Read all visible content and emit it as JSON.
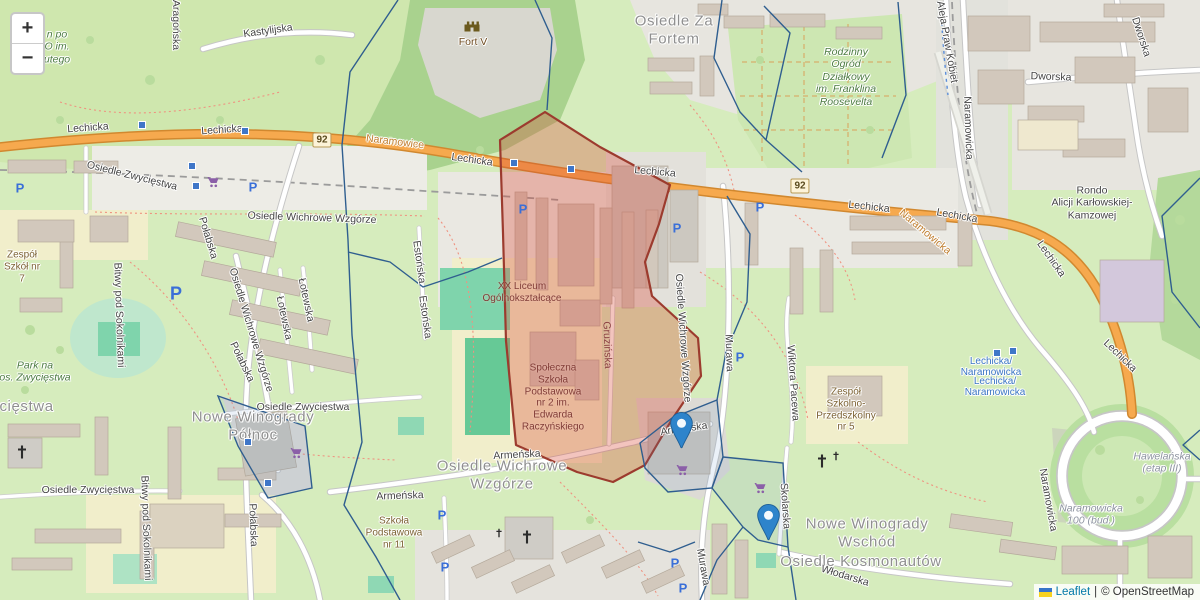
{
  "map": {
    "controls": {
      "zoom_in": "+",
      "zoom_out": "−"
    },
    "attribution": {
      "leaflet": "Leaflet",
      "separator": "|",
      "osm": "© OpenStreetMap"
    },
    "road_refs": [
      {
        "text": "92",
        "x": 322,
        "y": 140
      },
      {
        "text": "92",
        "x": 800,
        "y": 186
      }
    ],
    "labels": [
      {
        "t": "Osiedle Za\nFortem",
        "x": 674,
        "y": 30,
        "c": "district"
      },
      {
        "t": "Nowe Winogrady\nPółnoc",
        "x": 253,
        "y": 426,
        "c": "district"
      },
      {
        "t": "Osiedle Wichrowe\nWzgórze",
        "x": 502,
        "y": 475,
        "c": "district"
      },
      {
        "t": "Nowe Winogrady\nWschód",
        "x": 867,
        "y": 533,
        "c": "district"
      },
      {
        "t": "Osiedle Kosmonautów",
        "x": 861,
        "y": 562,
        "c": "district"
      },
      {
        "t": "Osiedle Zwycięstwa",
        "x": -18,
        "y": 407,
        "c": "district"
      },
      {
        "t": "Lechicka",
        "x": 88,
        "y": 128,
        "c": "street",
        "r": -4
      },
      {
        "t": "Lechicka",
        "x": 222,
        "y": 130,
        "c": "street",
        "r": -4
      },
      {
        "t": "Lechicka",
        "x": 472,
        "y": 160,
        "c": "street",
        "r": 8
      },
      {
        "t": "Lechicka",
        "x": 655,
        "y": 172,
        "c": "street",
        "r": 5
      },
      {
        "t": "Lechicka",
        "x": 869,
        "y": 207,
        "c": "street",
        "r": 6
      },
      {
        "t": "Lechicka",
        "x": 957,
        "y": 216,
        "c": "street",
        "r": 10
      },
      {
        "t": "Lechicka",
        "x": 1051,
        "y": 259,
        "c": "street",
        "r": 55
      },
      {
        "t": "Lechicka",
        "x": 1120,
        "y": 356,
        "c": "street",
        "r": 44
      },
      {
        "t": "Kastylijska",
        "x": 268,
        "y": 31,
        "c": "street",
        "r": -8
      },
      {
        "t": "Aragońska",
        "x": 176,
        "y": 25,
        "c": "street",
        "r": 90
      },
      {
        "t": "Dworska",
        "x": 1051,
        "y": 77,
        "c": "street",
        "r": 2
      },
      {
        "t": "Dworska",
        "x": 1141,
        "y": 37,
        "c": "street",
        "r": 72
      },
      {
        "t": "Osiedle Wichrowe Wzgórze",
        "x": 312,
        "y": 218,
        "c": "street",
        "r": 2
      },
      {
        "t": "Osiedle Wichrowe Wzgórze",
        "x": 251,
        "y": 330,
        "c": "street",
        "r": 73
      },
      {
        "t": "Osiedle Wichrowe Wzgórze",
        "x": 683,
        "y": 338,
        "c": "street",
        "r": 86
      },
      {
        "t": "Osiedle Zwycięstwa",
        "x": 132,
        "y": 176,
        "c": "street",
        "r": 14
      },
      {
        "t": "Osiedle Zwycięstwa",
        "x": 303,
        "y": 407,
        "c": "street"
      },
      {
        "t": "Osiedle Zwycięstwa",
        "x": 88,
        "y": 490,
        "c": "street"
      },
      {
        "t": "Połabska",
        "x": 208,
        "y": 238,
        "c": "street",
        "r": 73
      },
      {
        "t": "Połabska",
        "x": 242,
        "y": 362,
        "c": "street",
        "r": 64
      },
      {
        "t": "Połabska",
        "x": 253,
        "y": 525,
        "c": "street",
        "r": 88
      },
      {
        "t": "Bitwy pod Sokolnikami",
        "x": 119,
        "y": 315,
        "c": "street",
        "r": 88
      },
      {
        "t": "Bitwy pod Sokolnikami",
        "x": 146,
        "y": 528,
        "c": "street",
        "r": 88
      },
      {
        "t": "Estońska",
        "x": 419,
        "y": 262,
        "c": "street",
        "r": 82
      },
      {
        "t": "Estońska",
        "x": 425,
        "y": 317,
        "c": "street",
        "r": 82
      },
      {
        "t": "Łotewska",
        "x": 284,
        "y": 318,
        "c": "street",
        "r": 78
      },
      {
        "t": "Łotewska",
        "x": 306,
        "y": 300,
        "c": "street",
        "r": 78
      },
      {
        "t": "Gruzińska",
        "x": 607,
        "y": 345,
        "c": "street-red",
        "r": 88
      },
      {
        "t": "Murawa",
        "x": 729,
        "y": 353,
        "c": "street",
        "r": 88
      },
      {
        "t": "Murawa",
        "x": 703,
        "y": 567,
        "c": "street",
        "r": 80
      },
      {
        "t": "Armeńska",
        "x": 517,
        "y": 455,
        "c": "street",
        "r": -3
      },
      {
        "t": "Armeńska",
        "x": 400,
        "y": 496,
        "c": "street",
        "r": -2
      },
      {
        "t": "Armeńska",
        "x": 684,
        "y": 429,
        "c": "street",
        "r": -8
      },
      {
        "t": "Wiktora Pacewa",
        "x": 793,
        "y": 383,
        "c": "street",
        "r": 86
      },
      {
        "t": "Skolarska",
        "x": 785,
        "y": 506,
        "c": "street",
        "r": 86
      },
      {
        "t": "Włodarska",
        "x": 845,
        "y": 576,
        "c": "street",
        "r": 17
      },
      {
        "t": "Naramowicka",
        "x": 968,
        "y": 128,
        "c": "street",
        "r": 88
      },
      {
        "t": "Naramowicka",
        "x": 1048,
        "y": 500,
        "c": "street",
        "r": 80
      },
      {
        "t": "Aleja Praw Kobiet",
        "x": 947,
        "y": 42,
        "c": "street",
        "r": 80
      },
      {
        "t": "Rondo\nAlicji Karłowskiej-\nKamzowej",
        "x": 1092,
        "y": 203,
        "c": "street"
      },
      {
        "t": "Lechicka/\nNaramowicka",
        "x": 991,
        "y": 367,
        "c": "transit"
      },
      {
        "t": "Lechicka/\nNaramowicka",
        "x": 995,
        "y": 387,
        "c": "transit"
      },
      {
        "t": "Naramowice",
        "x": 395,
        "y": 142,
        "c": "orange",
        "r": 7
      },
      {
        "t": "Naramowicka",
        "x": 925,
        "y": 232,
        "c": "orange",
        "r": 40
      },
      {
        "t": "Fort V",
        "x": 473,
        "y": 42,
        "c": "fort"
      },
      {
        "t": "Zespół\nSzkół nr\n7",
        "x": 22,
        "y": 267,
        "c": "school"
      },
      {
        "t": "XX Liceum\nOgólnokształcące",
        "x": 522,
        "y": 293,
        "c": "school-red"
      },
      {
        "t": "Społeczna\nSzkoła\nPodstawowa\nnr 2 im.\nEdwarda\nRaczyńskiego",
        "x": 553,
        "y": 398,
        "c": "school-red"
      },
      {
        "t": "Szkoła\nPodstawowa\nnr 11",
        "x": 394,
        "y": 533,
        "c": "school"
      },
      {
        "t": "Zespół\nSzkolno-\nPrzedszkolny\nnr 5",
        "x": 846,
        "y": 410,
        "c": "school"
      },
      {
        "t": "Rodzinny\nOgród\nDziałkowy\nim. Franklina\nRoosevelta",
        "x": 846,
        "y": 77,
        "c": "park"
      },
      {
        "t": "Park na\nos. Zwycięstwa",
        "x": 35,
        "y": 372,
        "c": "park"
      },
      {
        "t": "n po\nO im.\nutego",
        "x": 57,
        "y": 47,
        "c": "park"
      },
      {
        "t": "Hawelańska\n(etap III)",
        "x": 1162,
        "y": 463,
        "c": "gray-i"
      },
      {
        "t": "Naramowicka\n100 (bud.)",
        "x": 1091,
        "y": 515,
        "c": "gray-i"
      }
    ],
    "markers": [
      {
        "x": 681,
        "y": 449
      },
      {
        "x": 768,
        "y": 541
      }
    ],
    "icons": {
      "parking_glyph": "P",
      "parking": [
        {
          "x": 20,
          "y": 188
        },
        {
          "x": 253,
          "y": 187
        },
        {
          "x": 523,
          "y": 209
        },
        {
          "x": 677,
          "y": 228
        },
        {
          "x": 760,
          "y": 207
        },
        {
          "x": 176,
          "y": 294,
          "big": true
        },
        {
          "x": 442,
          "y": 515
        },
        {
          "x": 445,
          "y": 567
        },
        {
          "x": 675,
          "y": 563
        },
        {
          "x": 683,
          "y": 588
        },
        {
          "x": 740,
          "y": 357
        }
      ],
      "supermarket": [
        {
          "x": 213,
          "y": 182
        },
        {
          "x": 296,
          "y": 453
        },
        {
          "x": 682,
          "y": 470
        },
        {
          "x": 760,
          "y": 488
        }
      ],
      "church": [
        {
          "x": 22,
          "y": 452,
          "big": true
        },
        {
          "x": 527,
          "y": 537,
          "big": true
        },
        {
          "x": 499,
          "y": 533
        },
        {
          "x": 822,
          "y": 461,
          "big": true
        },
        {
          "x": 836,
          "y": 456
        }
      ],
      "castle": [
        {
          "x": 472,
          "y": 26
        }
      ],
      "transit_stops": [
        {
          "x": 142,
          "y": 125
        },
        {
          "x": 245,
          "y": 131
        },
        {
          "x": 514,
          "y": 163
        },
        {
          "x": 571,
          "y": 169
        },
        {
          "x": 997,
          "y": 353
        },
        {
          "x": 1013,
          "y": 351
        },
        {
          "x": 248,
          "y": 442
        },
        {
          "x": 268,
          "y": 483
        },
        {
          "x": 192,
          "y": 166
        },
        {
          "x": 196,
          "y": 186
        }
      ]
    },
    "colors": {
      "overlay_red_fill": "rgba(217,72,54,0.32)",
      "overlay_red_stroke": "#9c3b2e",
      "overlay_blue_stroke": "#2f5e8f",
      "overlay_blue_fill": "rgba(90,140,200,0.12)",
      "road_trunk": "#f6a94e",
      "road_trunk_casing": "#d1882f",
      "marker": "#2e84cb",
      "marker_stroke": "#1e5f96",
      "label_district": "#8f8f8f",
      "label_street": "#444444",
      "label_school": "#7c6233",
      "label_green": "#4d7c42",
      "label_orange": "#bf7d2d",
      "label_transit": "#3a75c4",
      "parking": "#3a6fd8",
      "supermarket": "#8b5fa8",
      "stop": "#3f76c8",
      "attr_link": "#0078a8",
      "attr_text": "#333333"
    }
  }
}
